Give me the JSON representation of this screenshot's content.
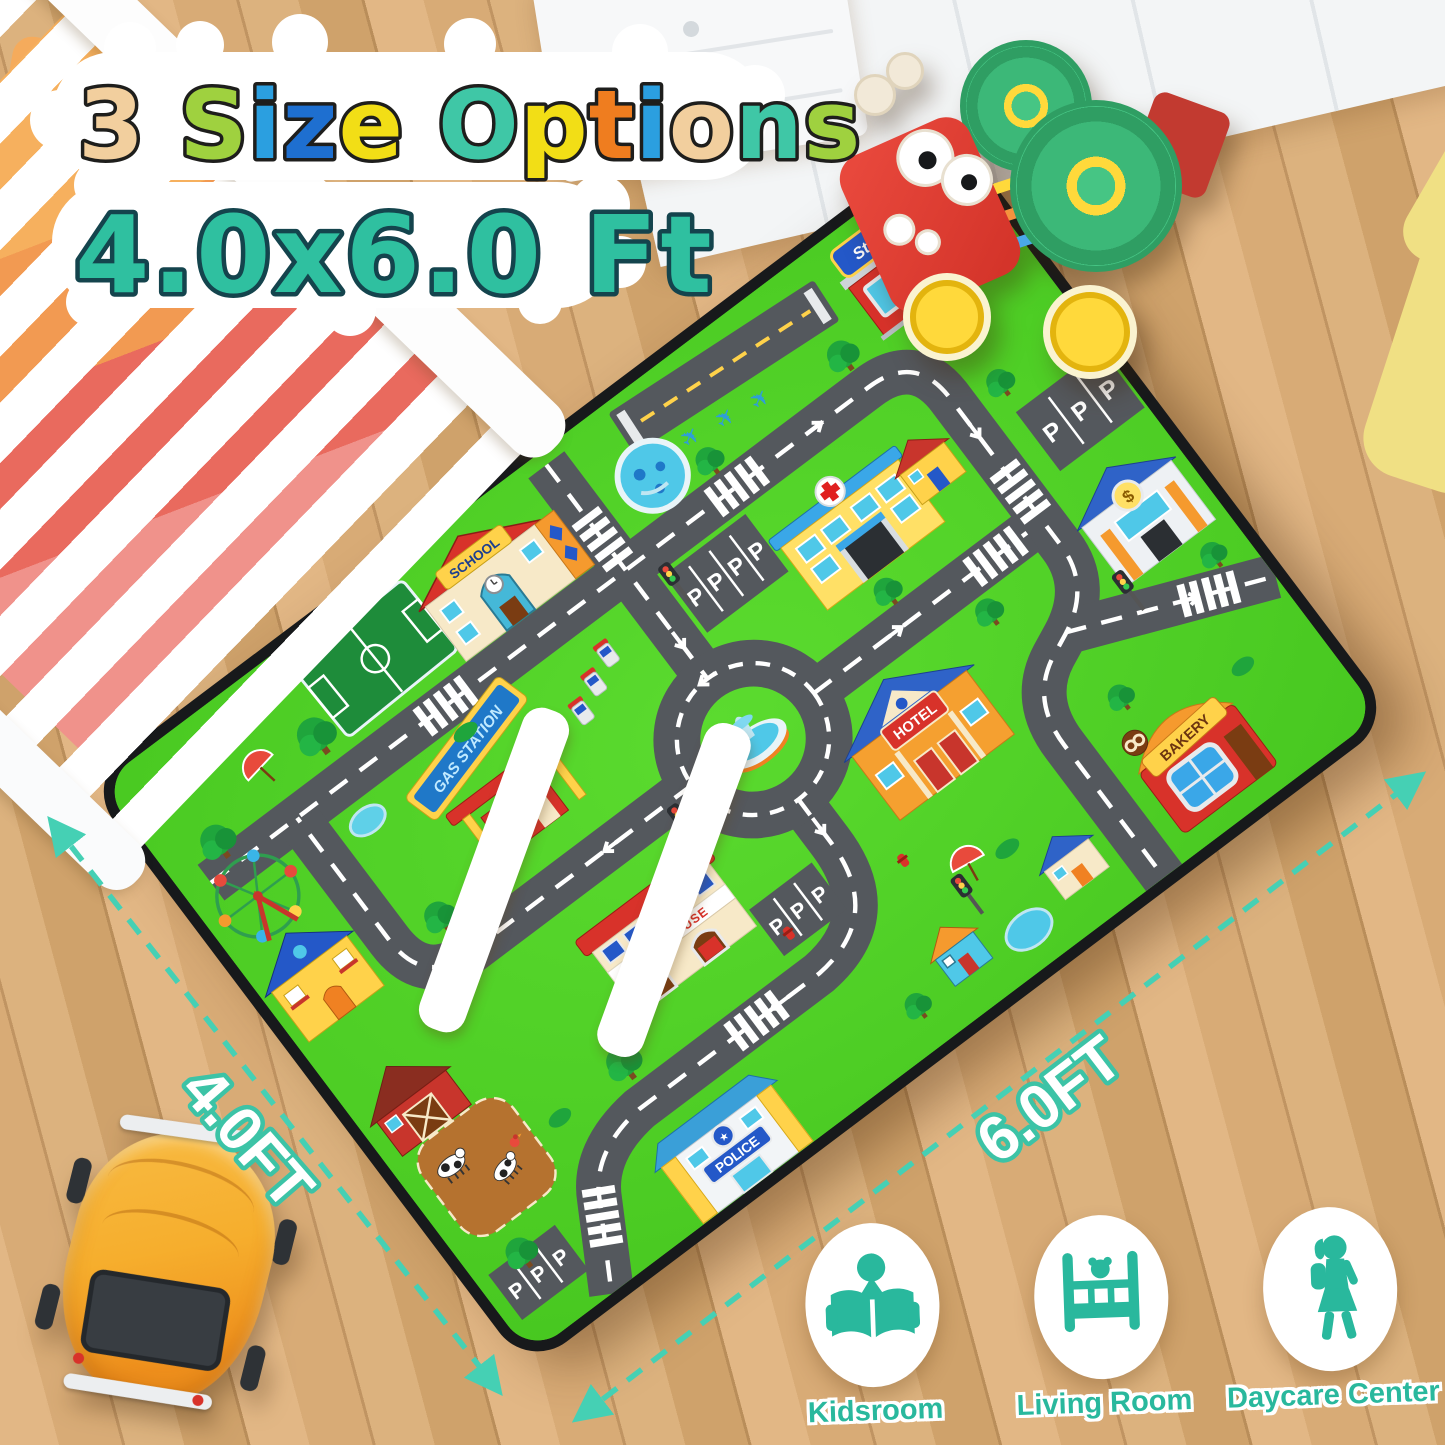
{
  "title": {
    "line1": "3 Size Options",
    "line1_letters": [
      {
        "ch": "3",
        "color": "#f2cf9e"
      },
      {
        "ch": " "
      },
      {
        "ch": "S",
        "color": "#9fd13f"
      },
      {
        "ch": "i",
        "color": "#2b9fe0"
      },
      {
        "ch": "z",
        "color": "#1e6fd0"
      },
      {
        "ch": "e",
        "color": "#f2de16"
      },
      {
        "ch": " "
      },
      {
        "ch": "O",
        "color": "#3fc7a6"
      },
      {
        "ch": "p",
        "color": "#f2de16"
      },
      {
        "ch": "t",
        "color": "#ef7d1f"
      },
      {
        "ch": "i",
        "color": "#2b9fe0"
      },
      {
        "ch": "o",
        "color": "#f2cf9e"
      },
      {
        "ch": "n",
        "color": "#3fc7a6"
      },
      {
        "ch": "s",
        "color": "#9fd13f"
      }
    ],
    "line2": "4.0x6.0 Ft"
  },
  "dimensions": {
    "side_label": "4.0FT",
    "bottom_label": "6.0FT"
  },
  "mat_labels": {
    "school": "SCHOOL",
    "store": "Store",
    "hotel": "HOTEL",
    "bakery": "BAKERY",
    "fire_house": "FIRE HOUSE",
    "gas_station": "GAS STATION",
    "police": "POLICE",
    "parking": "P"
  },
  "mat_icons": {
    "plane": "✈",
    "star": "★",
    "dollar": "$"
  },
  "usage_icons": [
    {
      "icon": "reading-child-icon",
      "label": "Kidsroom"
    },
    {
      "icon": "crib-icon",
      "label": "Living Room"
    },
    {
      "icon": "walking-girl-icon",
      "label": "Daycare Center"
    }
  ],
  "colors": {
    "accent_teal": "#2fc0a0",
    "dimension_teal": "#45d0b4",
    "icon_teal": "#29b89d",
    "mat_green": "#52d228",
    "road_gray": "#54585d"
  }
}
